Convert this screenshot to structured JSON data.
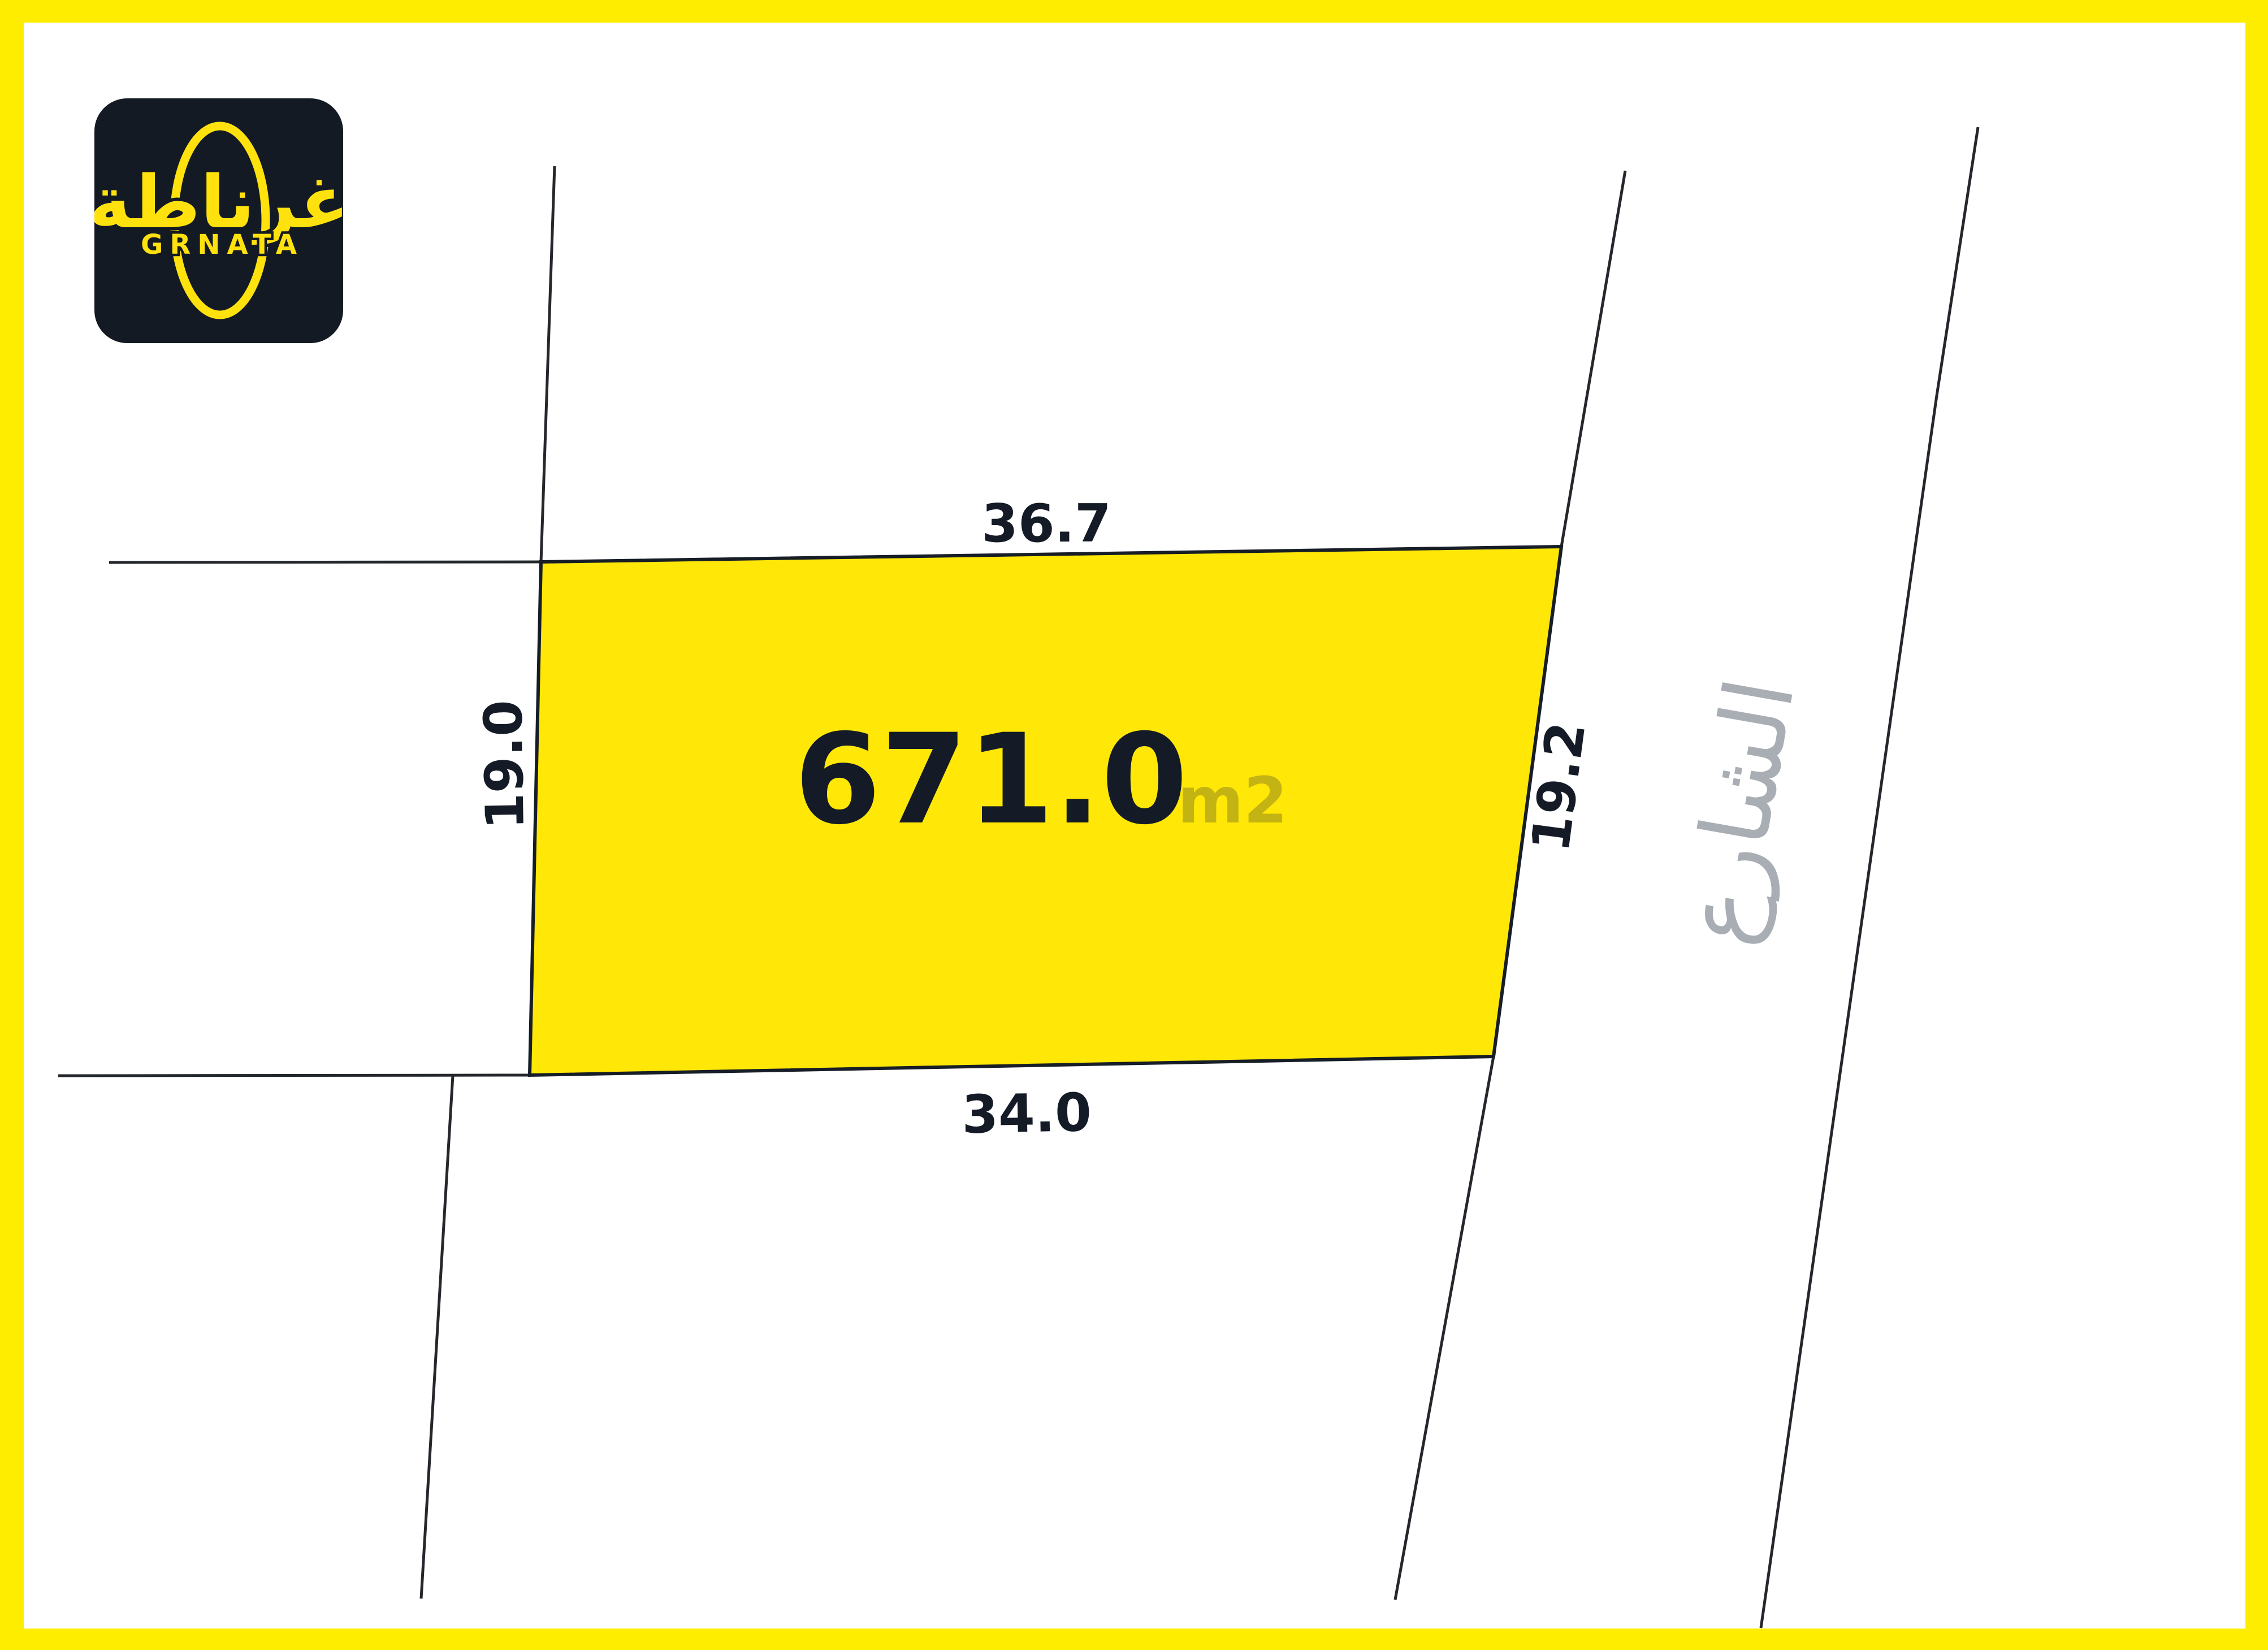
{
  "brand": {
    "arabic_wordmark": "غرناطة",
    "latin_wordmark": "GRNATA"
  },
  "parcel": {
    "area_value": "671.0",
    "area_unit": "m2",
    "edge_labels": {
      "top": "36.7",
      "left": "19.0",
      "right": "19.2",
      "bottom": "34.0"
    },
    "street_label": "الشارع"
  },
  "colors": {
    "frame_yellow": "#ffed00",
    "parcel_yellow": "#ffe708",
    "logo_navy": "#131a24",
    "logo_yellow": "#ffe10e",
    "boundary_line": "#24272c",
    "area_text": "#141b26",
    "area_unit_olive": "#c3b313",
    "street_gray": "#a9aeb4"
  }
}
